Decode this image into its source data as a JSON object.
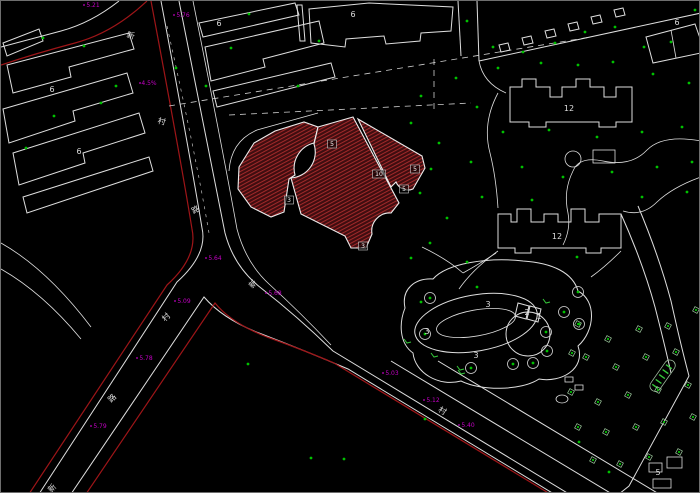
{
  "drawing_title": "residential-site-plan-cad",
  "colors": {
    "background": "#000000",
    "cad_white": "#dedede",
    "road_red": "#9e1518",
    "hatch_bg": "#3f0d10",
    "hatch_line": "#a32a2a",
    "tree_green": "#00c000",
    "magenta": "#c400c4",
    "green_label": "#35c83a"
  },
  "labels": {
    "building_numbers": [
      {
        "text": "6",
        "x": 51,
        "y": 91
      },
      {
        "text": "6",
        "x": 78,
        "y": 153
      },
      {
        "text": "6",
        "x": 218,
        "y": 25
      },
      {
        "text": "6",
        "x": 352,
        "y": 16
      },
      {
        "text": "6",
        "x": 676,
        "y": 24
      },
      {
        "text": "12",
        "x": 568,
        "y": 110
      },
      {
        "text": "12",
        "x": 556,
        "y": 238
      },
      {
        "text": "3",
        "x": 487,
        "y": 306
      },
      {
        "text": "3",
        "x": 426,
        "y": 333
      },
      {
        "text": "3",
        "x": 475,
        "y": 357
      },
      {
        "text": "2",
        "x": 526,
        "y": 314
      },
      {
        "text": "1",
        "x": 538,
        "y": 318
      },
      {
        "text": "5",
        "x": 657,
        "y": 474
      }
    ],
    "site_numbers": [
      {
        "text": "5",
        "x": 331,
        "y": 145
      },
      {
        "text": "10",
        "x": 378,
        "y": 175
      },
      {
        "text": "5",
        "x": 414,
        "y": 170
      },
      {
        "text": "5",
        "x": 403,
        "y": 190
      },
      {
        "text": "3",
        "x": 288,
        "y": 201
      },
      {
        "text": "3",
        "x": 362,
        "y": 247
      }
    ],
    "elevations": [
      {
        "text": "5.21",
        "x": 92,
        "y": 6
      },
      {
        "text": "5.76",
        "x": 182,
        "y": 16
      },
      {
        "text": "4.5%",
        "x": 148,
        "y": 84
      },
      {
        "text": "5.64",
        "x": 214,
        "y": 259
      },
      {
        "text": "5.68",
        "x": 274,
        "y": 294
      },
      {
        "text": "5.09",
        "x": 183,
        "y": 302
      },
      {
        "text": "5.78",
        "x": 145,
        "y": 359
      },
      {
        "text": "5.79",
        "x": 99,
        "y": 427
      },
      {
        "text": "5.03",
        "x": 391,
        "y": 374
      },
      {
        "text": "5.12",
        "x": 432,
        "y": 401
      },
      {
        "text": "5.40",
        "x": 467,
        "y": 426
      }
    ],
    "road_chars": [
      {
        "text": "新",
        "x": 129,
        "y": 37,
        "rot": 15
      },
      {
        "text": "村",
        "x": 160,
        "y": 123,
        "rot": 15
      },
      {
        "text": "路",
        "x": 196,
        "y": 211,
        "rot": -30
      },
      {
        "text": "新",
        "x": 254,
        "y": 285,
        "rot": -45
      },
      {
        "text": "村",
        "x": 167,
        "y": 318,
        "rot": -45
      },
      {
        "text": "路",
        "x": 113,
        "y": 399,
        "rot": -45
      },
      {
        "text": "新",
        "x": 53,
        "y": 489,
        "rot": -45
      },
      {
        "text": "村",
        "x": 440,
        "y": 412,
        "rot": 31
      }
    ]
  },
  "vegetation": {
    "tree_dots": [
      [
        42,
        37
      ],
      [
        83,
        45
      ],
      [
        115,
        85
      ],
      [
        100,
        102
      ],
      [
        53,
        115
      ],
      [
        25,
        147
      ],
      [
        175,
        67
      ],
      [
        205,
        85
      ],
      [
        248,
        13
      ],
      [
        230,
        47
      ],
      [
        318,
        40
      ],
      [
        297,
        85
      ],
      [
        420,
        95
      ],
      [
        455,
        77
      ],
      [
        410,
        122
      ],
      [
        438,
        142
      ],
      [
        430,
        168
      ],
      [
        419,
        192
      ],
      [
        446,
        217
      ],
      [
        429,
        242
      ],
      [
        410,
        257
      ],
      [
        466,
        20
      ],
      [
        492,
        46
      ],
      [
        522,
        51
      ],
      [
        554,
        42
      ],
      [
        584,
        31
      ],
      [
        614,
        26
      ],
      [
        643,
        46
      ],
      [
        670,
        41
      ],
      [
        694,
        9
      ],
      [
        497,
        67
      ],
      [
        540,
        62
      ],
      [
        577,
        64
      ],
      [
        612,
        61
      ],
      [
        652,
        73
      ],
      [
        688,
        82
      ],
      [
        476,
        106
      ],
      [
        502,
        131
      ],
      [
        548,
        129
      ],
      [
        596,
        136
      ],
      [
        641,
        131
      ],
      [
        681,
        126
      ],
      [
        470,
        161
      ],
      [
        521,
        166
      ],
      [
        562,
        176
      ],
      [
        611,
        171
      ],
      [
        656,
        166
      ],
      [
        691,
        161
      ],
      [
        481,
        196
      ],
      [
        531,
        199
      ],
      [
        641,
        196
      ],
      [
        686,
        191
      ],
      [
        466,
        261
      ],
      [
        476,
        286
      ],
      [
        420,
        301
      ],
      [
        576,
        256
      ],
      [
        247,
        363
      ],
      [
        310,
        457
      ],
      [
        424,
        418
      ],
      [
        343,
        458
      ],
      [
        578,
        441
      ],
      [
        608,
        471
      ]
    ],
    "circle_trees": [
      [
        429,
        297
      ],
      [
        577,
        291
      ],
      [
        563,
        311
      ],
      [
        578,
        323
      ],
      [
        545,
        331
      ],
      [
        546,
        350
      ],
      [
        532,
        362
      ],
      [
        512,
        363
      ],
      [
        470,
        367
      ],
      [
        424,
        333
      ]
    ],
    "tree_grid": [
      [
        577,
        323
      ],
      [
        607,
        338
      ],
      [
        638,
        328
      ],
      [
        667,
        325
      ],
      [
        695,
        309
      ],
      [
        585,
        356
      ],
      [
        615,
        366
      ],
      [
        645,
        356
      ],
      [
        675,
        351
      ],
      [
        571,
        352
      ],
      [
        570,
        391
      ],
      [
        597,
        401
      ],
      [
        627,
        394
      ],
      [
        657,
        389
      ],
      [
        687,
        384
      ],
      [
        577,
        426
      ],
      [
        605,
        431
      ],
      [
        635,
        426
      ],
      [
        663,
        421
      ],
      [
        692,
        416
      ],
      [
        592,
        459
      ],
      [
        619,
        463
      ],
      [
        648,
        456
      ],
      [
        678,
        451
      ]
    ],
    "plant_marks": [
      [
        433,
        355
      ],
      [
        459,
        368
      ],
      [
        406,
        341
      ],
      [
        545,
        301
      ],
      [
        460,
        372
      ]
    ]
  }
}
